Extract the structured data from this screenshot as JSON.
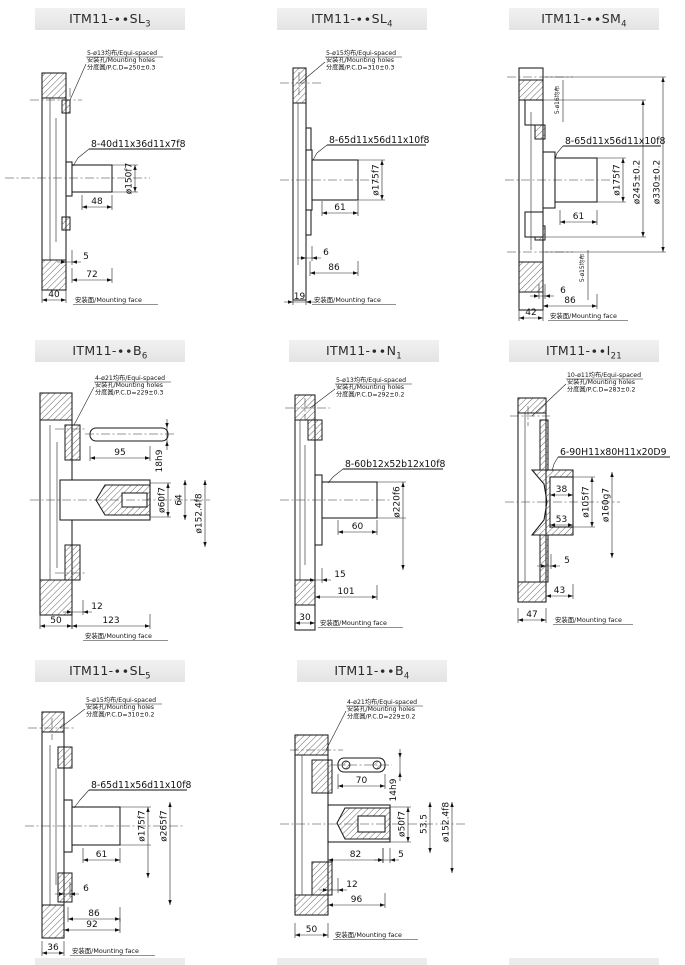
{
  "sheet": {
    "bg": "#ffffff",
    "titlebar_bg": "#ececec",
    "line_color": "#1a1a1a"
  },
  "panels": [
    {
      "id": "sl3",
      "title": "ITM11-∙∙SL",
      "title_sub": "3",
      "note": [
        "5-ø13均布/Equi-spaced",
        "安装孔/Mounting holes",
        "分度圆/P.C.D=250±0.3"
      ],
      "spline": "8-40d11x36d11x7f8",
      "vlabels": [
        "ø150f7"
      ],
      "dims": [
        "48",
        "5",
        "72",
        "40"
      ],
      "mount": "安装面/Mounting face"
    },
    {
      "id": "sl4",
      "title": "ITM11-∙∙SL",
      "title_sub": "4",
      "note": [
        "5-ø15均布/Equi-spaced",
        "安装孔/Mounting holes",
        "分度圆/P.C.D=310±0.3"
      ],
      "spline": "8-65d11x56d11x10f8",
      "vlabels": [
        "ø175f7"
      ],
      "dims": [
        "61",
        "6",
        "86",
        "19"
      ],
      "mount": "安装面/Mounting face"
    },
    {
      "id": "sm4",
      "title": "ITM11-∙∙SM",
      "title_sub": "4",
      "note_vertical": [
        "5-ø16均布",
        "5-ø15均布"
      ],
      "spline": "8-65d11x56d11x10f8",
      "vlabels": [
        "ø175f7",
        "ø245±0.2",
        "ø330±0.2"
      ],
      "dims": [
        "61",
        "6",
        "86",
        "42"
      ],
      "mount": "安装面/Mounting face"
    },
    {
      "id": "b6",
      "title": "ITM11-∙∙B",
      "title_sub": "6",
      "note": [
        "4-ø21均布/Equi-spaced",
        "安装孔/Mounting holes",
        "分度圆/P.C.D=229±0.3"
      ],
      "key": {
        "length": "95",
        "height": "18h9"
      },
      "vlabels": [
        "ø60f7",
        "64",
        "ø152.4f8"
      ],
      "dims": [
        "12",
        "123",
        "50"
      ],
      "mount": "安装面/Mounting face"
    },
    {
      "id": "n1",
      "title": "ITM11-∙∙N",
      "title_sub": "1",
      "note": [
        "5-ø13均布/Equi-spaced",
        "安装孔/Mounting holes",
        "分度圆/P.C.D=292±0.2"
      ],
      "spline": "8-60b12x52b12x10f8",
      "vlabels": [
        "ø220f6"
      ],
      "dims": [
        "60",
        "15",
        "101",
        "30"
      ],
      "mount": "安装面/Mounting face"
    },
    {
      "id": "i21",
      "title": "ITM11-∙∙I",
      "title_sub": "21",
      "note": [
        "10-ø11均布/Equi-spaced",
        "安装孔/Mounting holes",
        "分度圆/P.C.D=283±0.2"
      ],
      "spline": "6-90H11x80H11x20D9",
      "vlabels": [
        "ø105f7",
        "ø160g7"
      ],
      "dims": [
        "38",
        "53",
        "5",
        "43",
        "47"
      ],
      "mount": "安装面/Mounting face"
    },
    {
      "id": "sl5",
      "title": "ITM11-∙∙SL",
      "title_sub": "5",
      "note": [
        "5-ø15均布/Equi-spaced",
        "安装孔/Mounting holes",
        "分度圆/P.C.D=310±0.2"
      ],
      "spline": "8-65d11x56d11x10f8",
      "vlabels": [
        "ø175f7",
        "ø265f7"
      ],
      "dims": [
        "61",
        "6",
        "86",
        "92",
        "36"
      ],
      "mount": "安装面/Mounting face"
    },
    {
      "id": "b4",
      "title": "ITM11-∙∙B",
      "title_sub": "4",
      "note": [
        "4-ø21均布/Equi-spaced",
        "安装孔/Mounting holes",
        "分度圆/P.C.D=229±0.2"
      ],
      "key": {
        "length": "70",
        "height": "14h9"
      },
      "vlabels": [
        "ø50f7",
        "53.5",
        "ø152.4f8"
      ],
      "dims": [
        "82",
        "5",
        "12",
        "96",
        "50"
      ],
      "mount": "安装面/Mounting face"
    }
  ]
}
